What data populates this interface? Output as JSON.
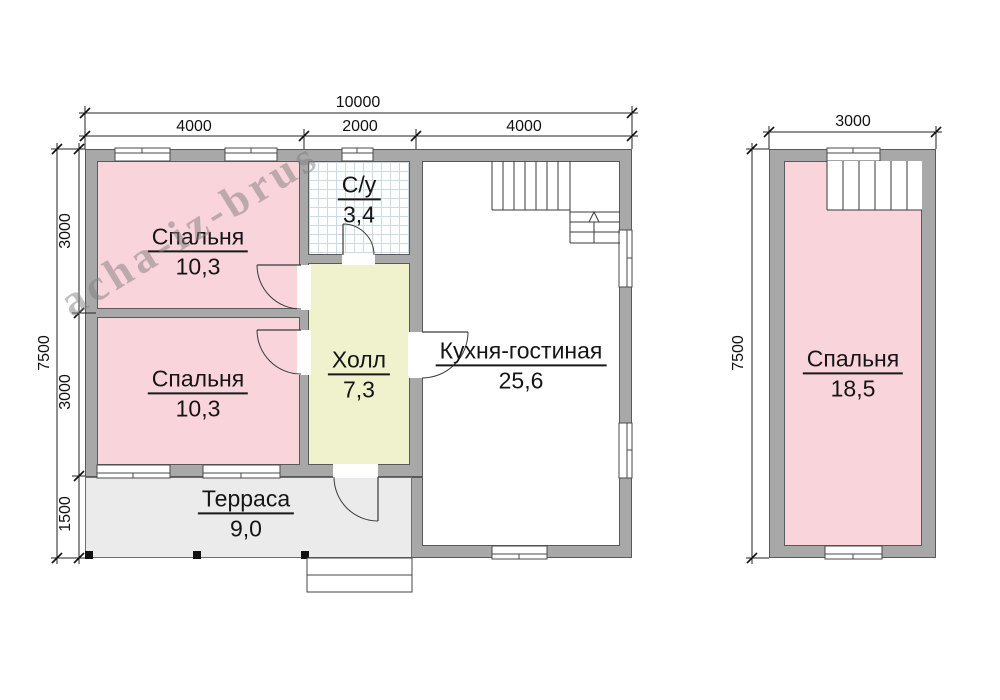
{
  "watermark_text": "acha-iz-brus",
  "floor1": {
    "dim_total_width": "10000",
    "dim_width_segments": [
      "4000",
      "2000",
      "4000"
    ],
    "dim_total_height": "7500",
    "dim_height_segments": [
      "3000",
      "3000",
      "1500"
    ],
    "rooms": {
      "bedroom1": {
        "name": "Спальня",
        "area": "10,3"
      },
      "bedroom2": {
        "name": "Спальня",
        "area": "10,3"
      },
      "bathroom": {
        "name": "С/у",
        "area": "3,4"
      },
      "hall": {
        "name": "Холл",
        "area": "7,3"
      },
      "kitchen_living": {
        "name": "Кухня-гостиная",
        "area": "25,6"
      },
      "terrace": {
        "name": "Терраса",
        "area": "9,0"
      }
    }
  },
  "floor2": {
    "dim_total_width": "3000",
    "dim_total_height": "7500",
    "rooms": {
      "bedroom": {
        "name": "Спальня",
        "area": "18,5"
      }
    }
  },
  "colors": {
    "wall_fill": "#a8a8a8",
    "wall_outline": "#5a5a5a",
    "bedroom_fill": "#f9d4da",
    "hall_fill": "#eff2cc",
    "terrace_fill": "#ebebeb",
    "bathroom_tile_line": "#c9dbe6",
    "watermark_gray": "#808080"
  }
}
